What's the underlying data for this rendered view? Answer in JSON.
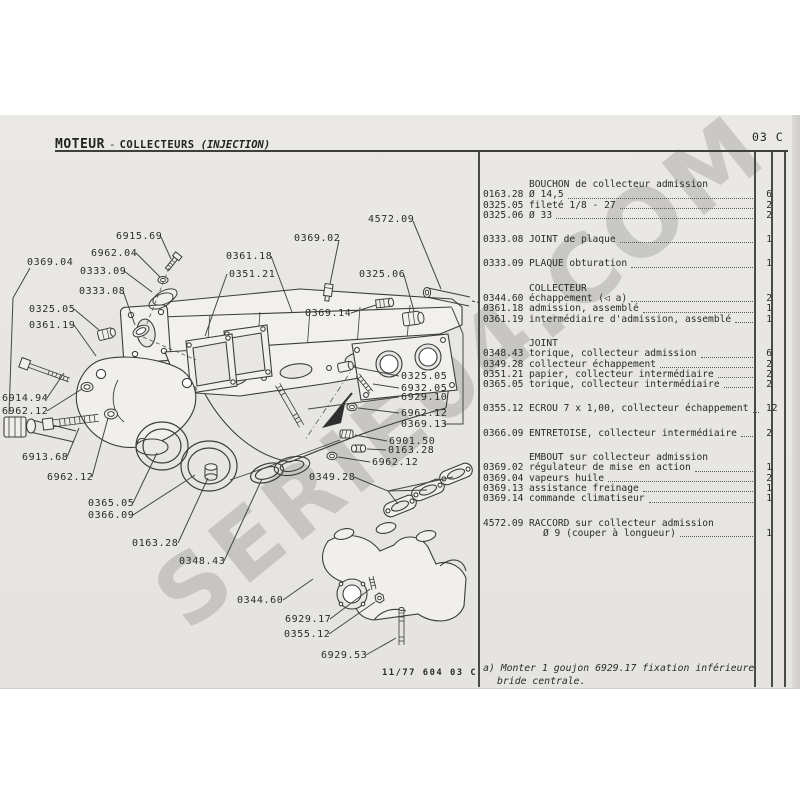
{
  "header": {
    "brand": "MOTEUR",
    "dash": "-",
    "section": "COLLECTEURS",
    "variant": "(INJECTION)",
    "page_code": "03 C"
  },
  "watermark": {
    "text": "SERIE04.COM"
  },
  "footer": {
    "plate_code": "11/77 604 03 C"
  },
  "footnote": {
    "line1": "a) Monter 1 goujon 6929.17 fixation inférieure",
    "line2": "bride centrale."
  },
  "parts_list": {
    "groups": [
      {
        "header": "BOUCHON de collecteur admission",
        "items": [
          {
            "ref": "0163.28",
            "desc": "Ø 14,5",
            "qty": "6"
          },
          {
            "ref": "0325.05",
            "desc": "fileté 1/8 - 27",
            "qty": "2"
          },
          {
            "ref": "0325.06",
            "desc": "Ø 33",
            "qty": "2"
          }
        ]
      },
      {
        "items": [
          {
            "ref": "0333.08",
            "desc": "JOINT de plaque",
            "qty": "1"
          }
        ]
      },
      {
        "items": [
          {
            "ref": "0333.09",
            "desc": "PLAQUE obturation",
            "qty": "1"
          }
        ]
      },
      {
        "header": "COLLECTEUR",
        "items": [
          {
            "ref": "0344.60",
            "desc": "échappement (◁ a)",
            "qty": "2"
          },
          {
            "ref": "0361.18",
            "desc": "admission, assemblé",
            "qty": "1"
          },
          {
            "ref": "0361.19",
            "desc": "intermédiaire d'admission, assemblé",
            "qty": "1"
          }
        ]
      },
      {
        "header": "JOINT",
        "items": [
          {
            "ref": "0348.43",
            "desc": "torique, collecteur admission",
            "qty": "6"
          },
          {
            "ref": "0349.28",
            "desc": "collecteur échappement",
            "qty": "2"
          },
          {
            "ref": "0351.21",
            "desc": "papier, collecteur intermédiaire",
            "qty": "2"
          },
          {
            "ref": "0365.05",
            "desc": "torique, collecteur intermédiaire",
            "qty": "2"
          }
        ]
      },
      {
        "items": [
          {
            "ref": "0355.12",
            "desc": "ECROU 7 x 1,00, collecteur échappement",
            "qty": "12"
          }
        ]
      },
      {
        "items": [
          {
            "ref": "0366.09",
            "desc": "ENTRETOISE, collecteur intermédiaire",
            "qty": "2"
          }
        ]
      },
      {
        "header": "EMBOUT sur collecteur admission",
        "items": [
          {
            "ref": "0369.02",
            "desc": "régulateur de mise en action",
            "qty": "1"
          },
          {
            "ref": "0369.04",
            "desc": "vapeurs huile",
            "qty": "2"
          },
          {
            "ref": "0369.13",
            "desc": "assistance freinage",
            "qty": "1"
          },
          {
            "ref": "0369.14",
            "desc": "commande climatiseur",
            "qty": "1"
          }
        ]
      },
      {
        "items": [
          {
            "ref": "4572.09",
            "desc": "RACCORD sur collecteur admission",
            "no_dots": true
          },
          {
            "ref": "",
            "desc": "Ø 9 (couper à longueur)",
            "qty": "1",
            "indent2": true
          }
        ]
      }
    ]
  },
  "diagram": {
    "labels": [
      {
        "text": "6915.69",
        "x": 116,
        "y": 231,
        "leaders": [
          [
            [
              161,
              237
            ],
            [
              171,
              259
            ]
          ]
        ]
      },
      {
        "text": "6962.04",
        "x": 91,
        "y": 248,
        "leaders": [
          [
            [
              136,
              253
            ],
            [
              160,
              277
            ]
          ]
        ]
      },
      {
        "text": "0333.09",
        "x": 80,
        "y": 266,
        "leaders": [
          [
            [
              124,
              271
            ],
            [
              152,
              292
            ]
          ]
        ]
      },
      {
        "text": "0333.08",
        "x": 79,
        "y": 286,
        "leaders": [
          [
            [
              123,
              291
            ],
            [
              135,
              325
            ]
          ]
        ]
      },
      {
        "text": "0369.04",
        "x": 27,
        "y": 257,
        "leaders": [
          [
            [
              30,
              268
            ],
            [
              13,
              298
            ],
            [
              9,
              414
            ]
          ]
        ]
      },
      {
        "text": "0325.05",
        "x": 29,
        "y": 304,
        "leaders": [
          [
            [
              74,
              309
            ],
            [
              99,
              330
            ]
          ]
        ]
      },
      {
        "text": "0361.19",
        "x": 29,
        "y": 320,
        "leaders": [
          [
            [
              74,
              325
            ],
            [
              96,
              356
            ]
          ]
        ]
      },
      {
        "text": "6914.94",
        "x": 2,
        "y": 393,
        "leaders": [
          [
            [
              47,
              398
            ],
            [
              64,
              373
            ]
          ]
        ]
      },
      {
        "text": "6962.12",
        "x": 2,
        "y": 406,
        "leaders": [
          [
            [
              47,
              411
            ],
            [
              82,
              389
            ]
          ]
        ]
      },
      {
        "text": "6913.68",
        "x": 22,
        "y": 452,
        "leaders": [
          [
            [
              67,
              457
            ],
            [
              79,
              428
            ]
          ]
        ]
      },
      {
        "text": "6962.12",
        "x": 47,
        "y": 472,
        "leaders": [
          [
            [
              92,
              477
            ],
            [
              108,
              418
            ]
          ]
        ]
      },
      {
        "text": "0365.05",
        "x": 88,
        "y": 498,
        "leaders": [
          [
            [
              133,
              503
            ],
            [
              157,
              453
            ]
          ]
        ]
      },
      {
        "text": "0366.09",
        "x": 88,
        "y": 510,
        "leaders": [
          [
            [
              133,
              515
            ],
            [
              195,
              475
            ]
          ]
        ]
      },
      {
        "text": "0163.28",
        "x": 132,
        "y": 538,
        "leaders": [
          [
            [
              178,
              543
            ],
            [
              208,
              478
            ]
          ]
        ]
      },
      {
        "text": "0348.43",
        "x": 179,
        "y": 556,
        "leaders": [
          [
            [
              224,
              561
            ],
            [
              262,
              479
            ]
          ]
        ]
      },
      {
        "text": "0361.18",
        "x": 226,
        "y": 251,
        "leaders": [
          [
            [
              271,
              256
            ],
            [
              292,
              312
            ]
          ]
        ]
      },
      {
        "text": "0351.21",
        "x": 229,
        "y": 269,
        "leaders": [
          [
            [
              227,
              274
            ],
            [
              205,
              336
            ]
          ]
        ]
      },
      {
        "text": "0369.02",
        "x": 294,
        "y": 233,
        "leaders": [
          [
            [
              339,
              240
            ],
            [
              330,
              284
            ]
          ]
        ]
      },
      {
        "text": "4572.09",
        "x": 368,
        "y": 214,
        "leaders": [
          [
            [
              413,
              221
            ],
            [
              441,
              289
            ]
          ]
        ]
      },
      {
        "text": "0325.06",
        "x": 359,
        "y": 269,
        "leaders": [
          [
            [
              404,
              275
            ],
            [
              414,
              311
            ]
          ]
        ]
      },
      {
        "text": "0369.14",
        "x": 305,
        "y": 308,
        "leaders": [
          [
            [
              351,
              313
            ],
            [
              376,
              305
            ]
          ]
        ]
      },
      {
        "text": "0325.05",
        "x": 401,
        "y": 371,
        "leaders": [
          [
            [
              399,
              376
            ],
            [
              353,
              367
            ]
          ]
        ]
      },
      {
        "text": "6932.05",
        "x": 401,
        "y": 383,
        "leaders": [
          [
            [
              399,
              388
            ],
            [
              373,
              384
            ]
          ]
        ]
      },
      {
        "text": "6929.10",
        "x": 401,
        "y": 392,
        "leaders": [
          [
            [
              399,
              397
            ],
            [
              308,
              409
            ]
          ]
        ]
      },
      {
        "text": "6962.12",
        "x": 401,
        "y": 408,
        "leaders": [
          [
            [
              399,
              413
            ],
            [
              358,
              408
            ]
          ]
        ]
      },
      {
        "text": "0369.13",
        "x": 401,
        "y": 419,
        "leaders": [
          [
            [
              444,
              424
            ],
            [
              463,
              424
            ],
            [
              463,
              334
            ],
            [
              452,
              308
            ]
          ]
        ]
      },
      {
        "text": "6901.50",
        "x": 389,
        "y": 436,
        "leaders": [
          [
            [
              387,
              441
            ],
            [
              355,
              435
            ]
          ]
        ]
      },
      {
        "text": "0163.28",
        "x": 388,
        "y": 445,
        "leaders": [
          [
            [
              386,
              450
            ],
            [
              367,
              449
            ]
          ]
        ]
      },
      {
        "text": "6962.12",
        "x": 372,
        "y": 457,
        "leaders": [
          [
            [
              370,
              462
            ],
            [
              338,
              457
            ]
          ]
        ]
      },
      {
        "text": "0349.28",
        "x": 309,
        "y": 472,
        "leaders": [
          [
            [
              354,
              477
            ],
            [
              388,
              491
            ]
          ],
          [
            [
              388,
              491
            ],
            [
              398,
              504
            ]
          ],
          [
            [
              388,
              491
            ],
            [
              427,
              490
            ]
          ],
          [
            [
              388,
              491
            ],
            [
              453,
              477
            ]
          ]
        ]
      },
      {
        "text": "0344.60",
        "x": 237,
        "y": 595,
        "leaders": [
          [
            [
              283,
              600
            ],
            [
              313,
              579
            ]
          ]
        ]
      },
      {
        "text": "6929.17",
        "x": 285,
        "y": 614,
        "leaders": [
          [
            [
              330,
              619
            ],
            [
              370,
              589
            ]
          ]
        ]
      },
      {
        "text": "0355.12",
        "x": 284,
        "y": 629,
        "leaders": [
          [
            [
              329,
              634
            ],
            [
              375,
              602
            ]
          ]
        ]
      },
      {
        "text": "6929.53",
        "x": 321,
        "y": 650,
        "leaders": [
          [
            [
              366,
              655
            ],
            [
              396,
              638
            ]
          ]
        ]
      }
    ]
  }
}
